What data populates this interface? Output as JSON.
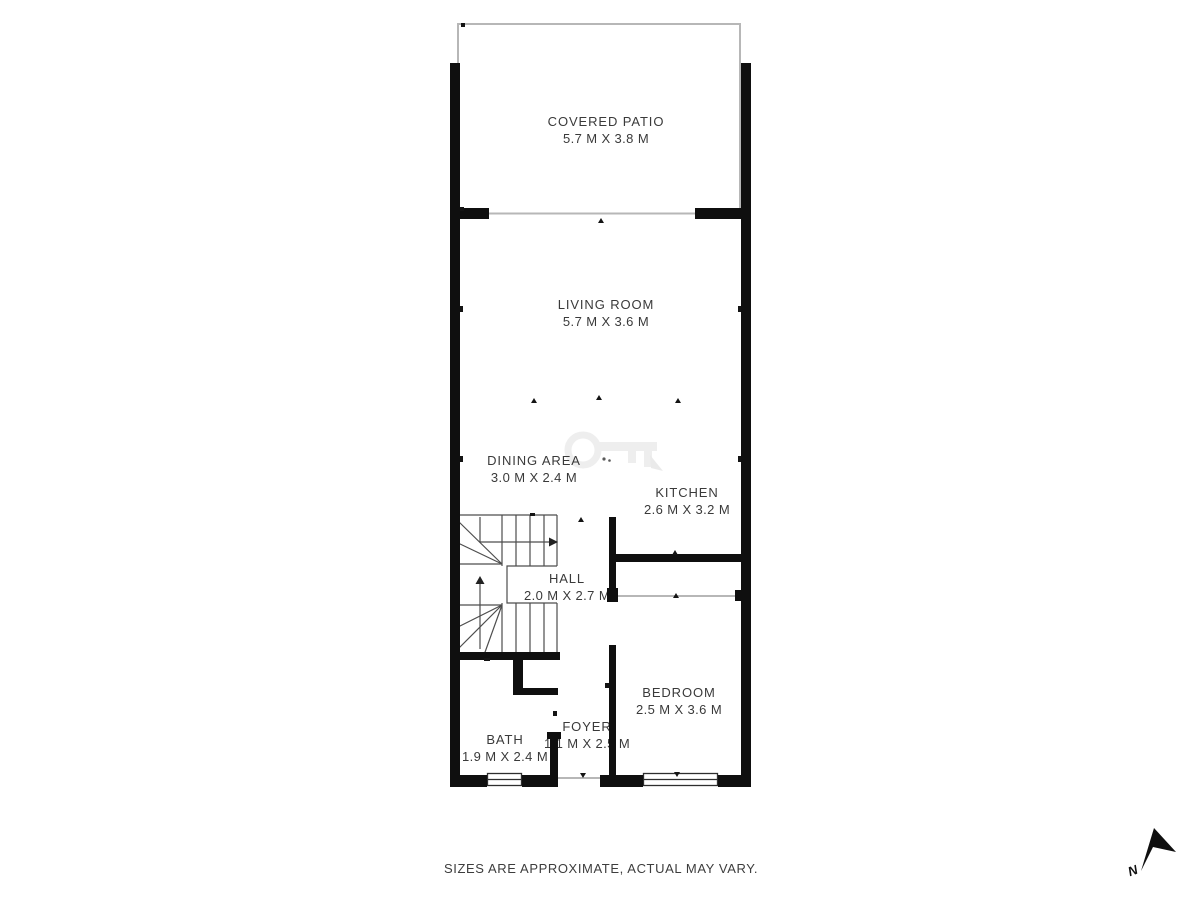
{
  "plan": {
    "rooms": [
      {
        "id": "covered-patio",
        "name": "COVERED PATIO",
        "dims": "5.7 M X 3.8 M"
      },
      {
        "id": "living-room",
        "name": "LIVING ROOM",
        "dims": "5.7 M X 3.6 M"
      },
      {
        "id": "dining-area",
        "name": "DINING AREA",
        "dims": "3.0 M X 2.4 M"
      },
      {
        "id": "kitchen",
        "name": "KITCHEN",
        "dims": "2.6 M X 3.2 M"
      },
      {
        "id": "hall",
        "name": "HALL",
        "dims": "2.0 M X 2.7 M"
      },
      {
        "id": "bedroom",
        "name": "BEDROOM",
        "dims": "2.5 M X 3.6 M"
      },
      {
        "id": "bath",
        "name": "BATH",
        "dims": "1.9 M X 2.4 M"
      },
      {
        "id": "foyer",
        "name": "FOYER",
        "dims": "1.1 M X 2.5 M"
      }
    ],
    "footer": {
      "disclaimer": "SIZES ARE APPROXIMATE, ACTUAL MAY VARY."
    },
    "compass": {
      "label": "N"
    },
    "colors": {
      "wall": "#0f0f0f",
      "thin_line": "#b7b7b7",
      "stair_line": "#4d4d4d",
      "text": "#3a3a3a",
      "watermark": "#e3e3e3"
    }
  }
}
